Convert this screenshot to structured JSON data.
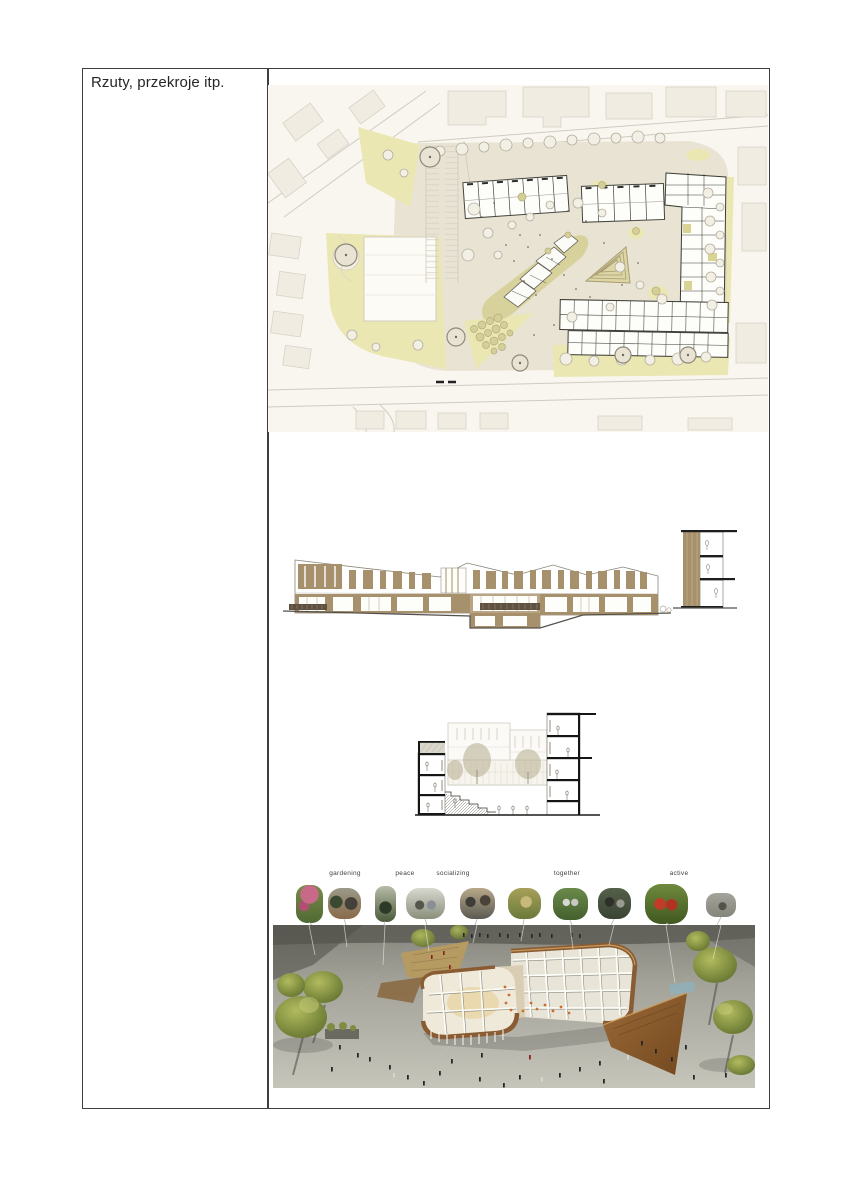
{
  "table": {
    "row_label": "Rzuty, przekroje itp."
  },
  "photo_strip": {
    "labels": [
      {
        "text": "gardening"
      },
      {
        "text": "peace"
      },
      {
        "text": "socializing"
      },
      {
        "text": "together"
      },
      {
        "text": "active"
      }
    ],
    "photo_count": 10
  },
  "figures": {
    "names": [
      "site-plan",
      "elevation",
      "section",
      "photo-strip",
      "aerial-render"
    ]
  },
  "colors": {
    "table_border": "#3e3e3e",
    "text": "#262626",
    "plan_lawn": "#ebe7b3",
    "plan_plaza": "#e9e3d4",
    "elevation_brown": "#a7916c",
    "render_wood": "#8a5c33",
    "render_green": "#7e8c3f",
    "active_red": "#c23a28"
  }
}
